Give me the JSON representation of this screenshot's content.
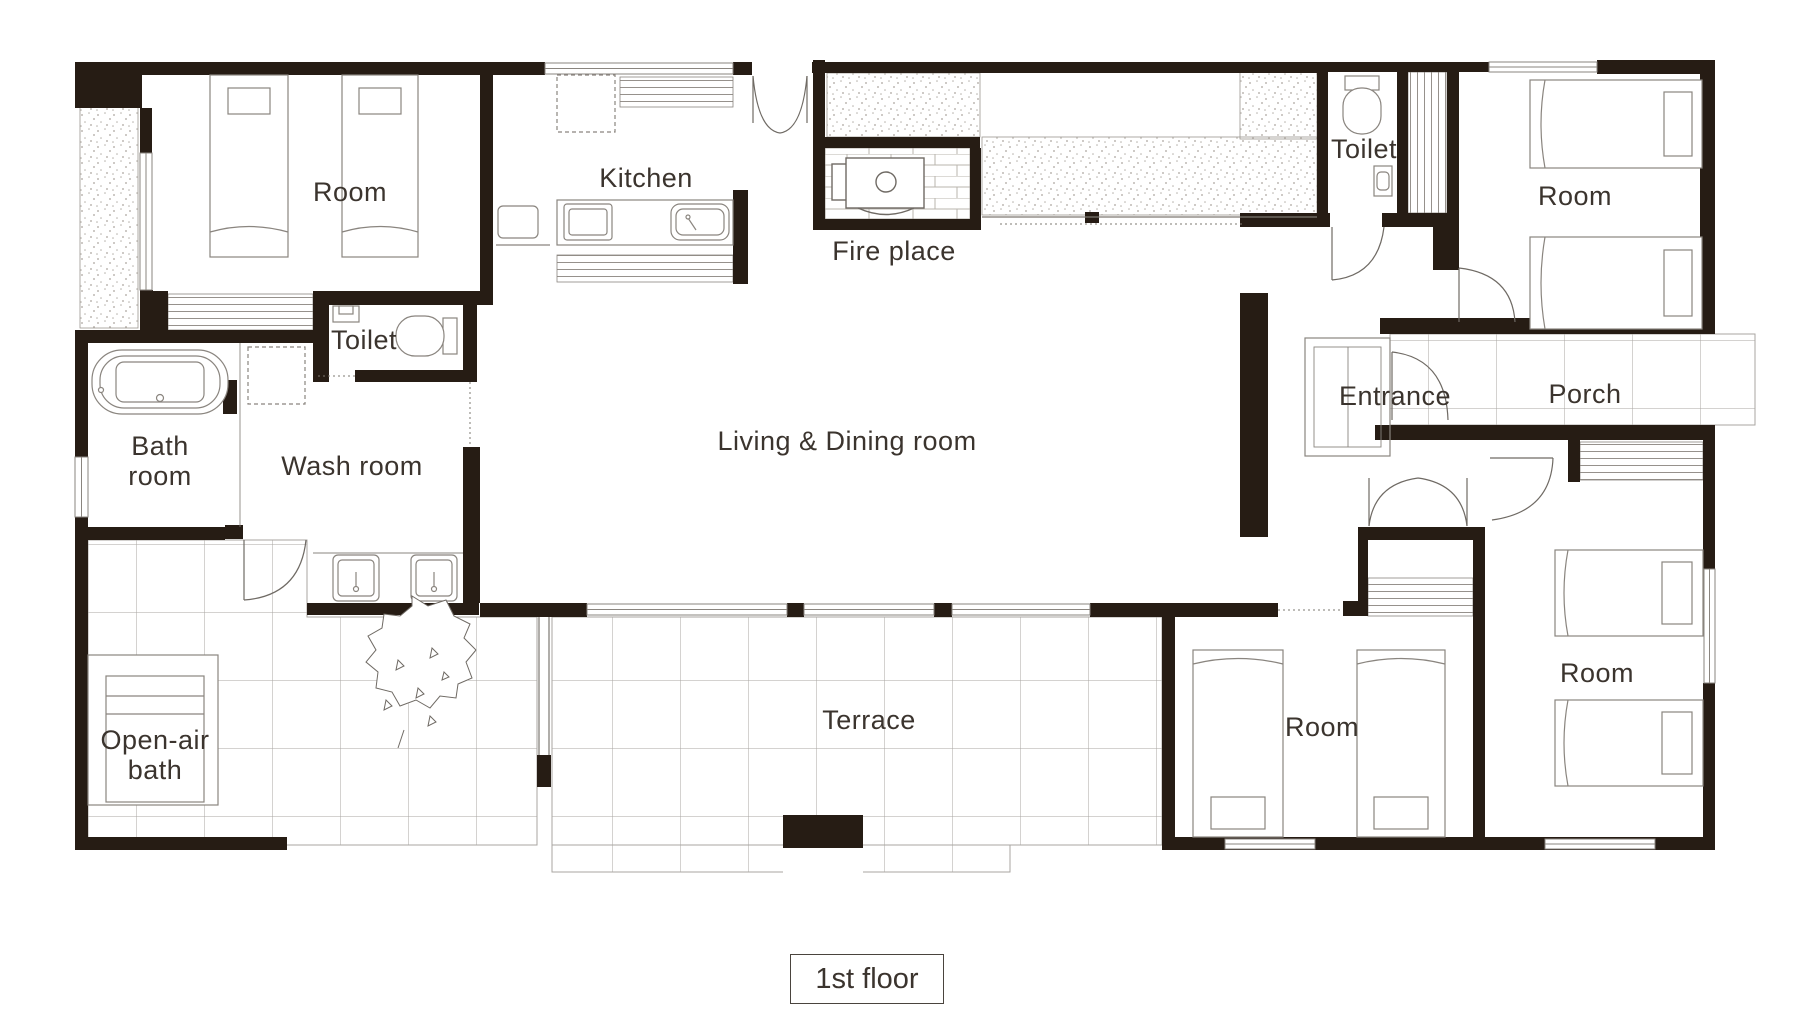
{
  "title": "House floor plan",
  "floor_label": "1st floor",
  "colors": {
    "wall": "#261c14",
    "line": "#8a857f",
    "text": "#3b342e",
    "background": "#ffffff"
  },
  "rooms": [
    {
      "id": "room-top-left",
      "label": "Room"
    },
    {
      "id": "kitchen",
      "label": "Kitchen"
    },
    {
      "id": "fire-place",
      "label": "Fire place"
    },
    {
      "id": "toilet-top-right",
      "label": "Toilet"
    },
    {
      "id": "room-top-right",
      "label": "Room"
    },
    {
      "id": "toilet-left",
      "label": "Toilet"
    },
    {
      "id": "bath-room",
      "label": "Bath\nroom"
    },
    {
      "id": "wash-room",
      "label": "Wash room"
    },
    {
      "id": "living-dining",
      "label": "Living & Dining room"
    },
    {
      "id": "entrance",
      "label": "Entrance"
    },
    {
      "id": "porch",
      "label": "Porch"
    },
    {
      "id": "open-air-bath",
      "label": "Open-air\nbath"
    },
    {
      "id": "terrace",
      "label": "Terrace"
    },
    {
      "id": "room-bottom-middle",
      "label": "Room"
    },
    {
      "id": "room-bottom-right",
      "label": "Room"
    }
  ]
}
